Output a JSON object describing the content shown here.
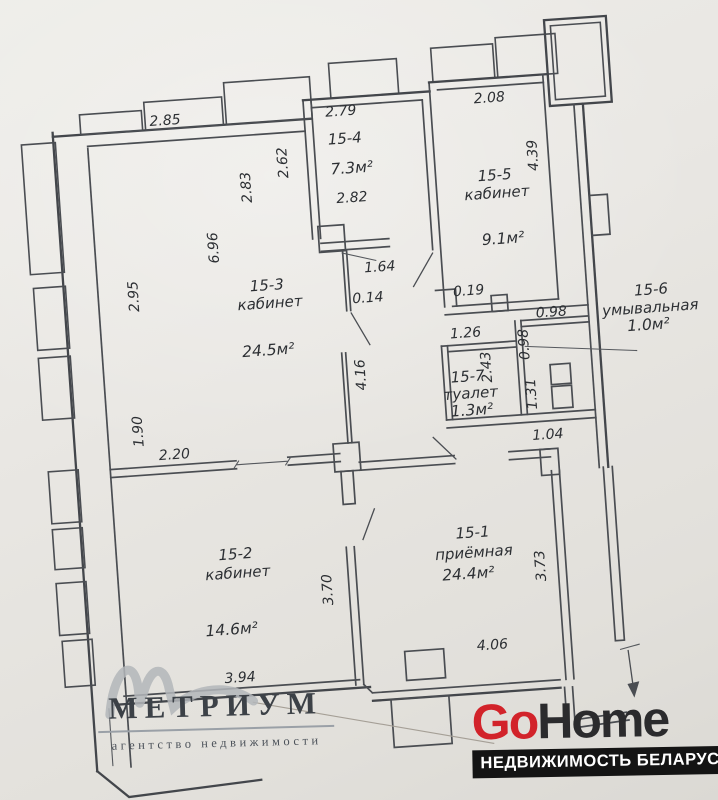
{
  "plan": {
    "rooms": {
      "r15_1": {
        "id": "15-1",
        "name": "приёмная",
        "area": "24.4м²"
      },
      "r15_2": {
        "id": "15-2",
        "name": "кабинет",
        "area": "14.6м²"
      },
      "r15_3": {
        "id": "15-3",
        "name": "кабинет",
        "area": "24.5м²"
      },
      "r15_4": {
        "id": "15-4",
        "area": "7.3м²"
      },
      "r15_5": {
        "id": "15-5",
        "name": "кабинет",
        "area": "9.1м²"
      },
      "r15_6": {
        "id": "15-6",
        "name": "умывальная",
        "area": "1.0м²"
      },
      "r15_7": {
        "id": "15-7",
        "name": "туалет",
        "area": "1.3м²"
      }
    },
    "dims": {
      "d285": "2.85",
      "d279": "2.79",
      "d262": "2.62",
      "d283": "2.83",
      "d282": "2.82",
      "d208": "2.08",
      "d439": "4.39",
      "d696": "6.96",
      "d295": "2.95",
      "d164": "1.64",
      "d014": "0.14",
      "d019": "0.19",
      "d126": "1.26",
      "d098h": "0.98",
      "d098v": "0.98",
      "d243": "2.43",
      "d131": "1.31",
      "d104": "1.04",
      "d416": "4.16",
      "d190": "1.90",
      "d220": "2.20",
      "d394": "3.94",
      "d370": "3.70",
      "d373": "3.73",
      "d406": "4.06"
    },
    "total_area": "82.2м"
  },
  "logos": {
    "metrium": {
      "title": "МЕТРИУМ",
      "tagline": "агентство недвижимости"
    },
    "gohome": {
      "part1": "Go",
      "part2": "Home",
      "tagline": "НЕДВИЖИМОСТЬ БЕЛАРУСИ",
      "accent": "#d2232a",
      "dark": "#2b2b2d",
      "bar_bg": "#141414"
    }
  }
}
